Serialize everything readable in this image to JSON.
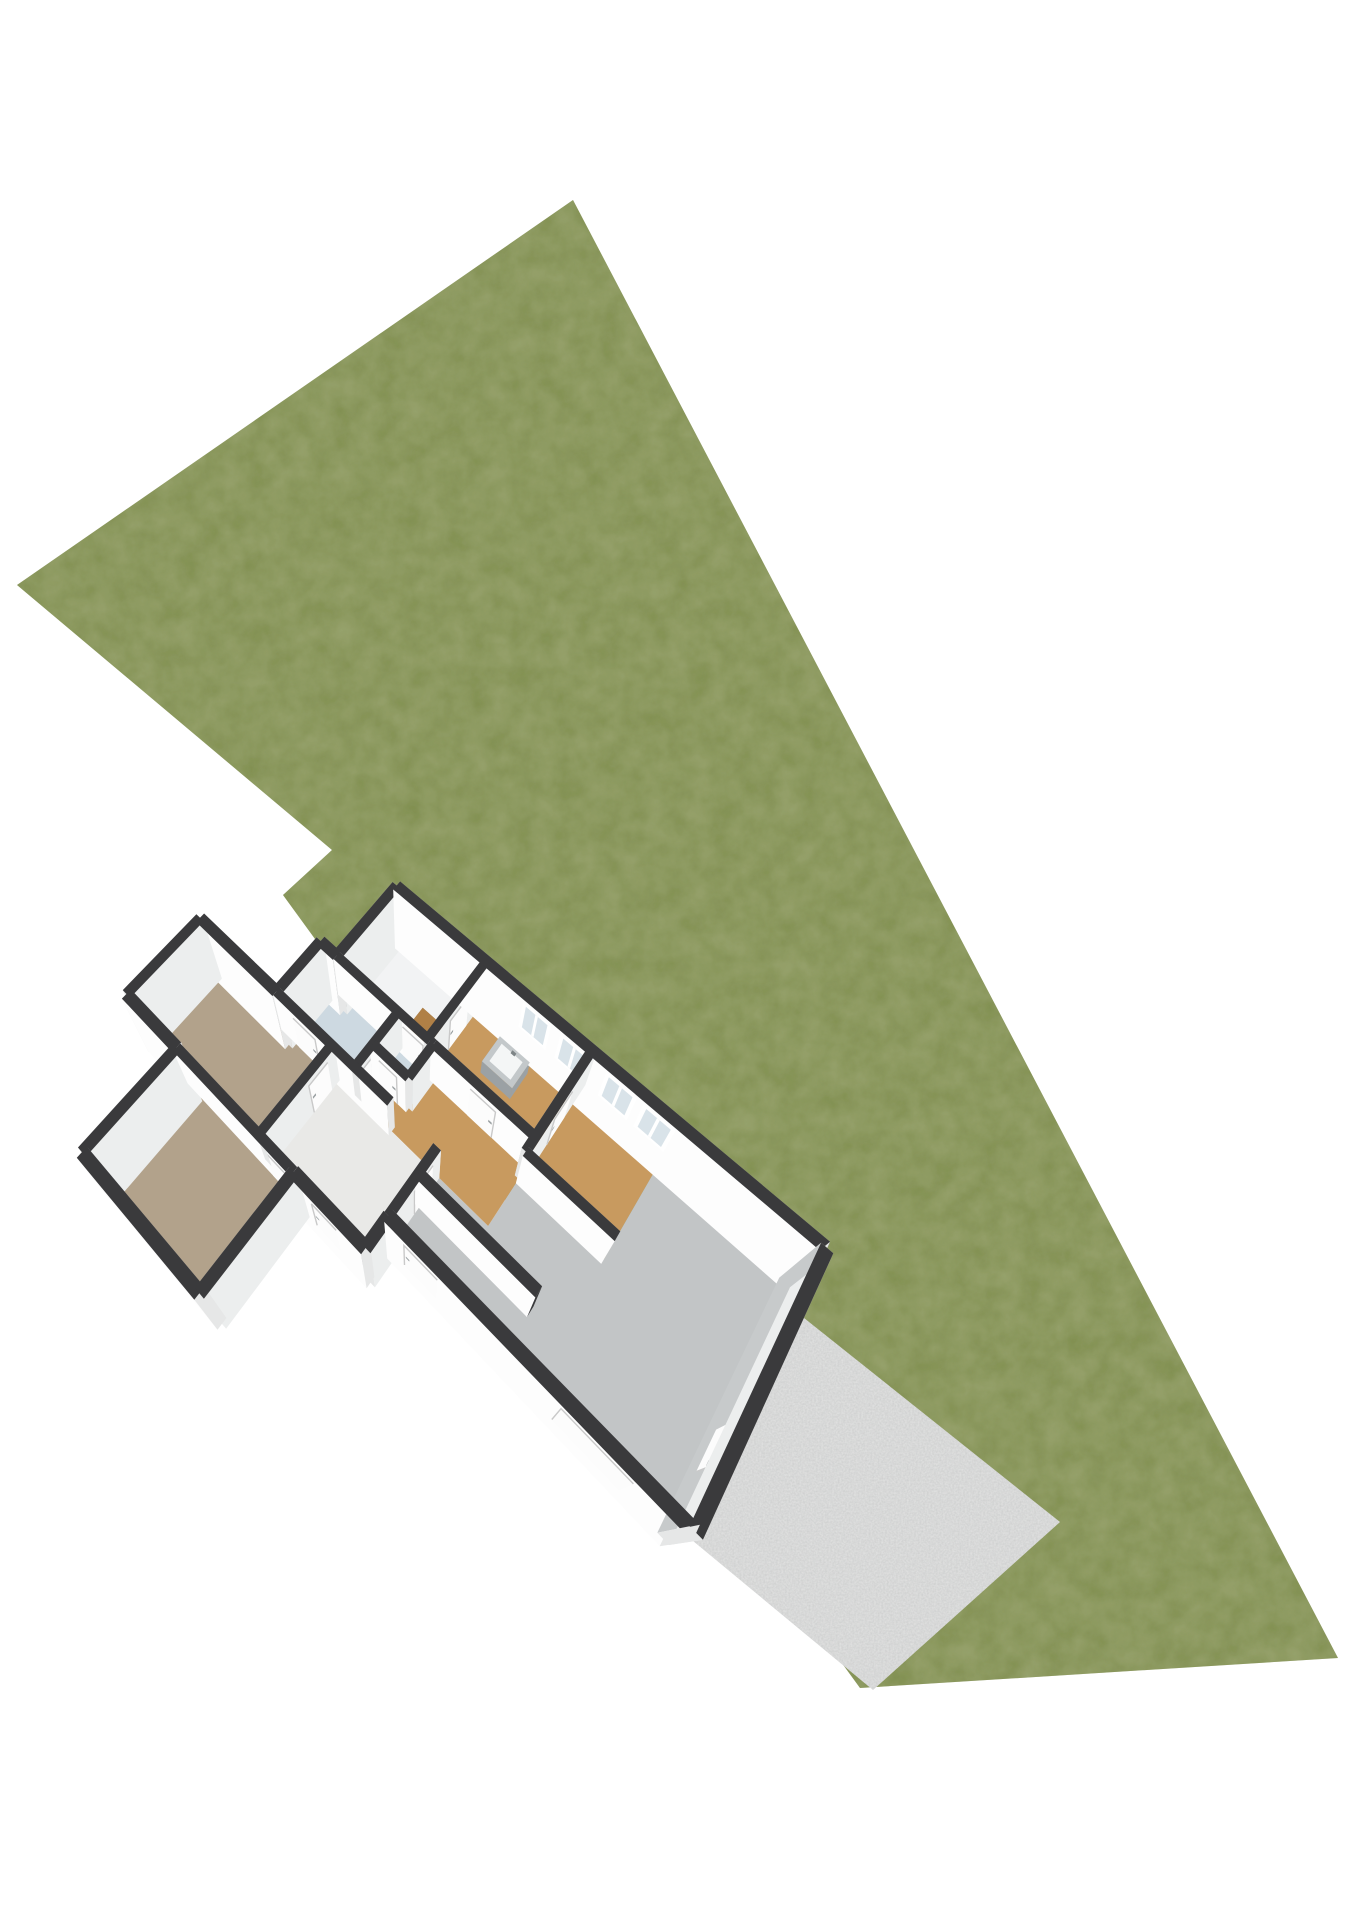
{
  "scene": {
    "name": "3d-site-floorplan-render",
    "background_color": "#ffffff",
    "plot": {
      "name": "grass-lawn",
      "color": "#7e8c4c",
      "texture_dark": "#42521f",
      "texture_light": "#9aa763"
    },
    "terrace": {
      "name": "concrete-terrace",
      "color": "#cbcccc",
      "speckle": "#f2f2f1"
    },
    "house": {
      "wall_top_color": "#3a3a3c",
      "wall_face_south": "#fdfdfd",
      "wall_face_north": "#b4b7b9",
      "wall_face_east": "#eceeee",
      "wall_face_west": "#c7cacb",
      "wall_cap": "#e6e7e7",
      "door_color": "#fcfcfc",
      "door_border": "#c9c9c9",
      "door_handle": "#9aa0a2",
      "window_frame": "#ffffff",
      "window_glass": "#d9e3e9",
      "window_count": 4,
      "exterior_door_count": 3,
      "interior_door_count": 10,
      "rooms": [
        {
          "name": "utility-room",
          "flooring": "vinyl",
          "floor_color": "#f2f3f4"
        },
        {
          "name": "kitchen",
          "flooring": "wood",
          "floor_color": "#c89a5f"
        },
        {
          "name": "dining-room",
          "flooring": "wood",
          "floor_color": "#c89a5f"
        },
        {
          "name": "living-room",
          "flooring": "concrete",
          "floor_color": "#c2c5c6"
        },
        {
          "name": "hallway",
          "flooring": "wood",
          "floor_color": "#c89a5f"
        },
        {
          "name": "toilet",
          "flooring": "tile",
          "floor_color": "#cdd9e1"
        },
        {
          "name": "bathroom",
          "flooring": "tile",
          "floor_color": "#cdd9e1"
        },
        {
          "name": "entry-hall",
          "flooring": "vinyl",
          "floor_color": "#e9e9e7"
        },
        {
          "name": "bedroom-1",
          "flooring": "carpet",
          "floor_color": "#b2a28b"
        },
        {
          "name": "bedroom-2",
          "flooring": "carpet",
          "floor_color": "#b2a28b"
        }
      ],
      "fixtures": [
        {
          "name": "kitchen-sink-unit",
          "body_color": "#9ba1a4",
          "top_color": "#c3c8ca",
          "basin_color": "#f4f6f6"
        },
        {
          "name": "wood-counter",
          "top_color": "#b08046",
          "side_color": "#8f6534"
        }
      ]
    }
  }
}
